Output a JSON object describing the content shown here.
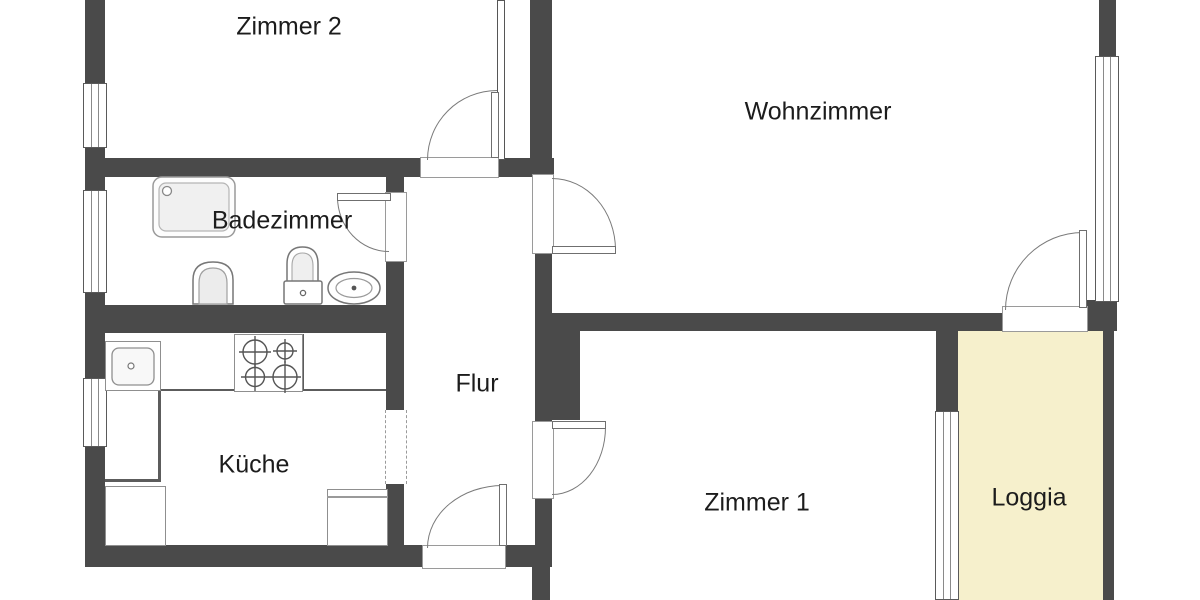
{
  "title": "Wohnungsgrundriss (apartment floor plan)",
  "colors": {
    "wall": "#4a4a4a",
    "loggia_fill": "#f6f0cc",
    "background": "#ffffff",
    "symbol_line": "#777777",
    "text": "#1c1c1c"
  },
  "rooms": [
    {
      "label": "Zimmer 2"
    },
    {
      "label": "Wohnzimmer"
    },
    {
      "label": "Badezimmer"
    },
    {
      "label": "Flur"
    },
    {
      "label": "Küche"
    },
    {
      "label": "Zimmer 1"
    },
    {
      "label": "Loggia"
    }
  ],
  "doors": [
    {
      "name": "door-zimmer2",
      "between": "Flur/Zimmer 2"
    },
    {
      "name": "door-badezimmer",
      "between": "Flur/Badezimmer"
    },
    {
      "name": "door-wohnzimmer",
      "between": "Flur/Wohnzimmer"
    },
    {
      "name": "door-zimmer1",
      "between": "Flur/Zimmer 1"
    },
    {
      "name": "door-entrance",
      "between": "Flur/outside"
    },
    {
      "name": "door-loggia",
      "between": "Wohnzimmer/Loggia"
    },
    {
      "name": "opening-kueche",
      "between": "Flur/Küche"
    }
  ],
  "windows": [
    {
      "name": "window-zimmer2-left"
    },
    {
      "name": "window-badezimmer-left"
    },
    {
      "name": "window-kueche-left"
    },
    {
      "name": "window-wohnzimmer-right"
    },
    {
      "name": "window-zimmer1-loggia"
    }
  ],
  "fixtures": [
    {
      "name": "shower-symbol",
      "room": "Badezimmer"
    },
    {
      "name": "toilet-symbol",
      "room": "Badezimmer"
    },
    {
      "name": "wc-cistern-symbol",
      "room": "Badezimmer"
    },
    {
      "name": "washbasin-symbol",
      "room": "Badezimmer"
    },
    {
      "name": "kitchen-sink-symbol",
      "room": "Küche"
    },
    {
      "name": "stove-symbol",
      "room": "Küche"
    },
    {
      "name": "cupboard-symbol",
      "room": "Küche"
    },
    {
      "name": "fridge-symbol",
      "room": "Küche"
    }
  ]
}
